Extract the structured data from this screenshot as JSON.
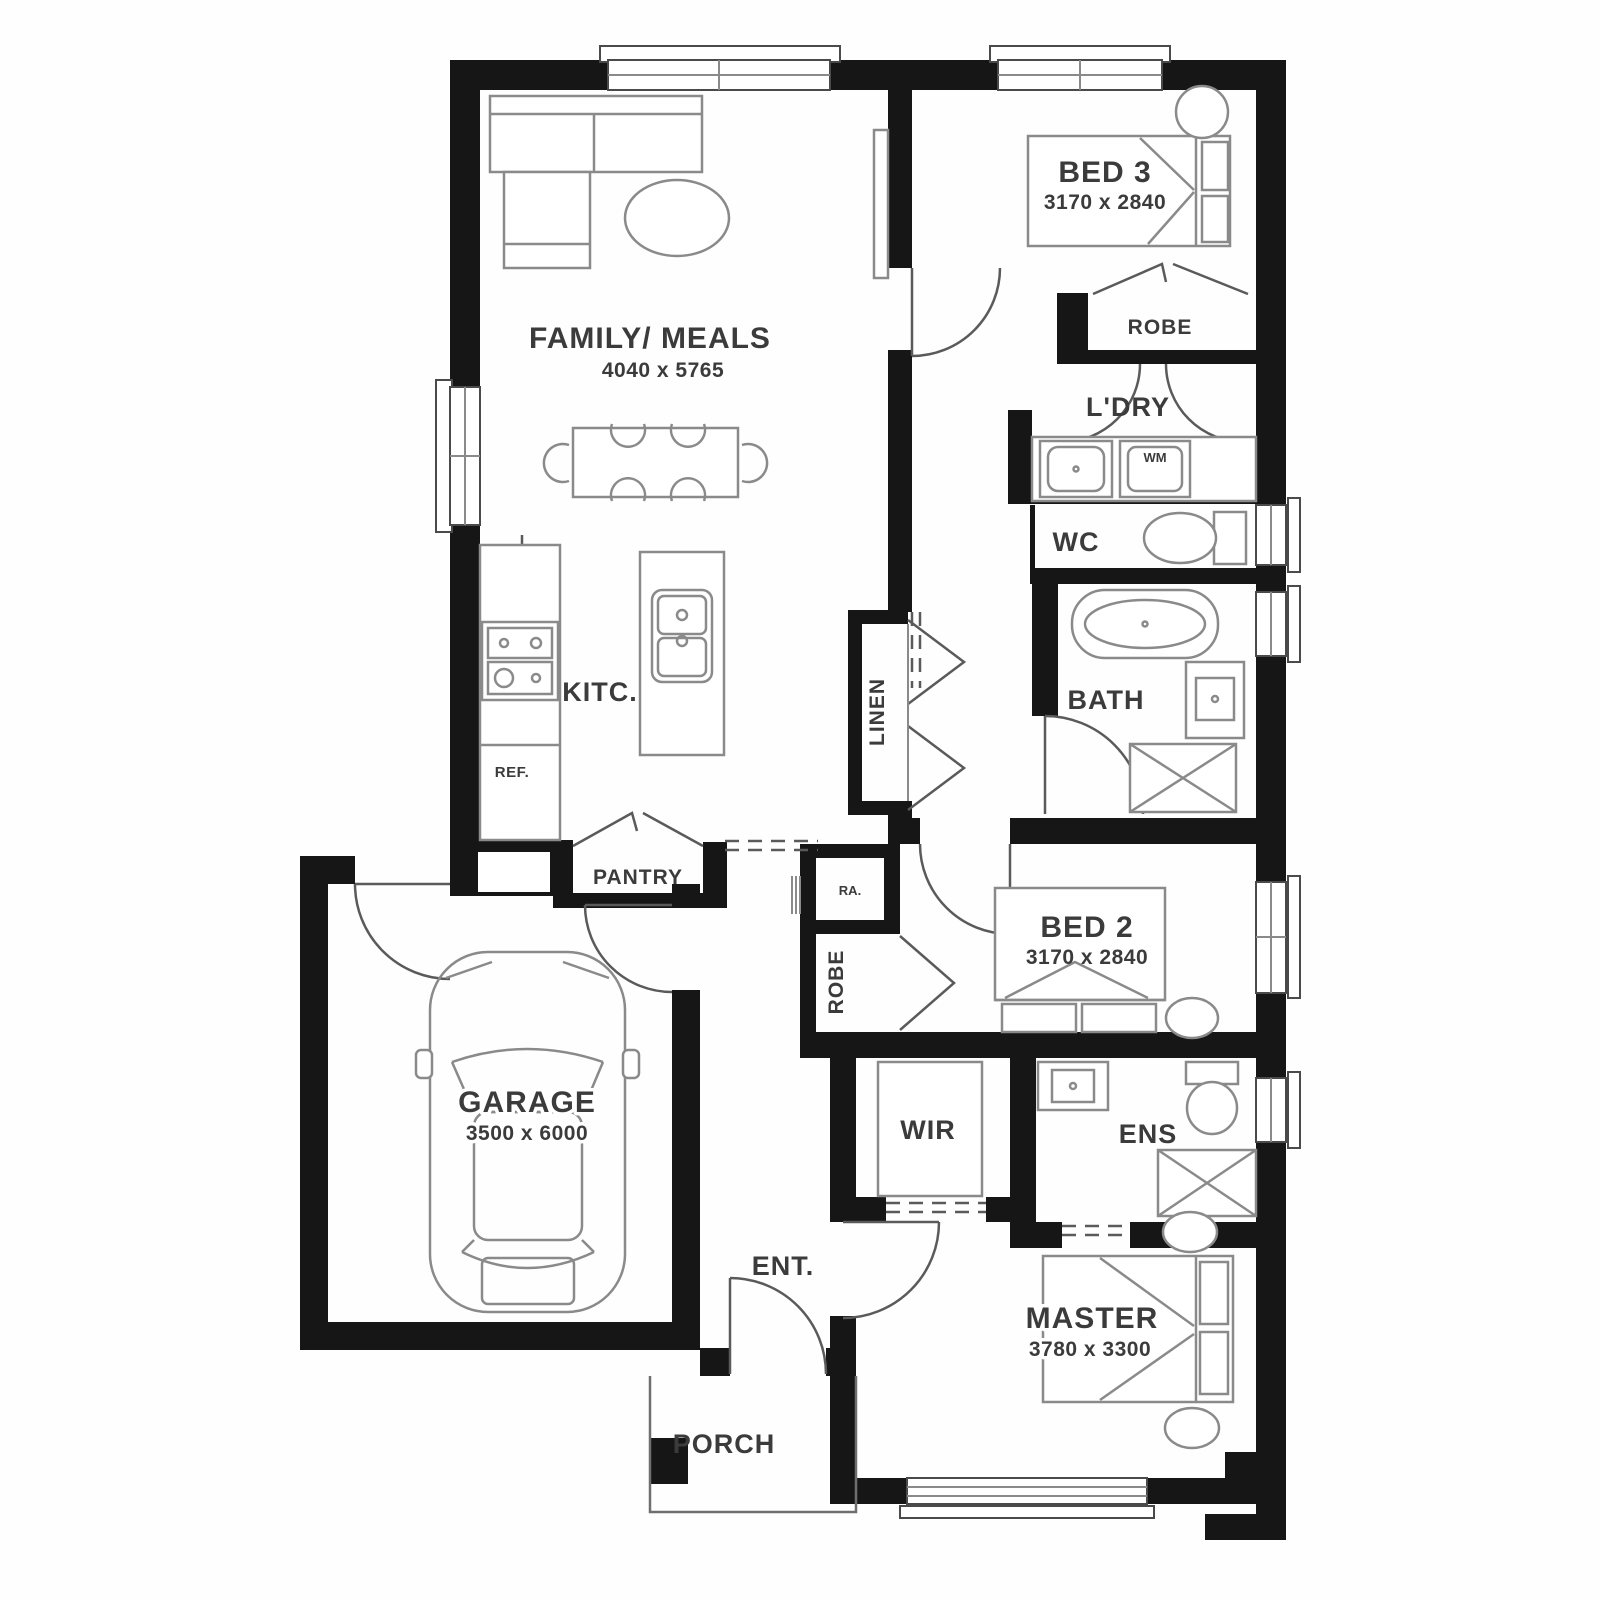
{
  "plan": {
    "title": "house-floor-plan",
    "colors": {
      "wall": "#161616",
      "line": "#8a8a8a",
      "label": "#3b3b3b",
      "background": "#fefefe"
    },
    "rooms": {
      "family": {
        "label": "FAMILY/ MEALS",
        "dims": "4040 x 5765"
      },
      "bed3": {
        "label": "BED 3",
        "dims": "3170 x 2840"
      },
      "robe3": {
        "label": "ROBE"
      },
      "ldry": {
        "label": "L'DRY"
      },
      "wm": {
        "label": "WM"
      },
      "wc": {
        "label": "WC"
      },
      "bath": {
        "label": "BATH"
      },
      "linen": {
        "label": "LINEN"
      },
      "kitchen": {
        "label": "KITC."
      },
      "fridge": {
        "label": "REF."
      },
      "pantry": {
        "label": "PANTRY"
      },
      "ra": {
        "label": "RA."
      },
      "robe2": {
        "label": "ROBE"
      },
      "bed2": {
        "label": "BED 2",
        "dims": "3170 x 2840"
      },
      "garage": {
        "label": "GARAGE",
        "dims": "3500 x 6000"
      },
      "wir": {
        "label": "WIR"
      },
      "ens": {
        "label": "ENS"
      },
      "entry": {
        "label": "ENT."
      },
      "master": {
        "label": "MASTER",
        "dims": "3780 x 3300"
      },
      "porch": {
        "label": "PORCH"
      }
    }
  }
}
